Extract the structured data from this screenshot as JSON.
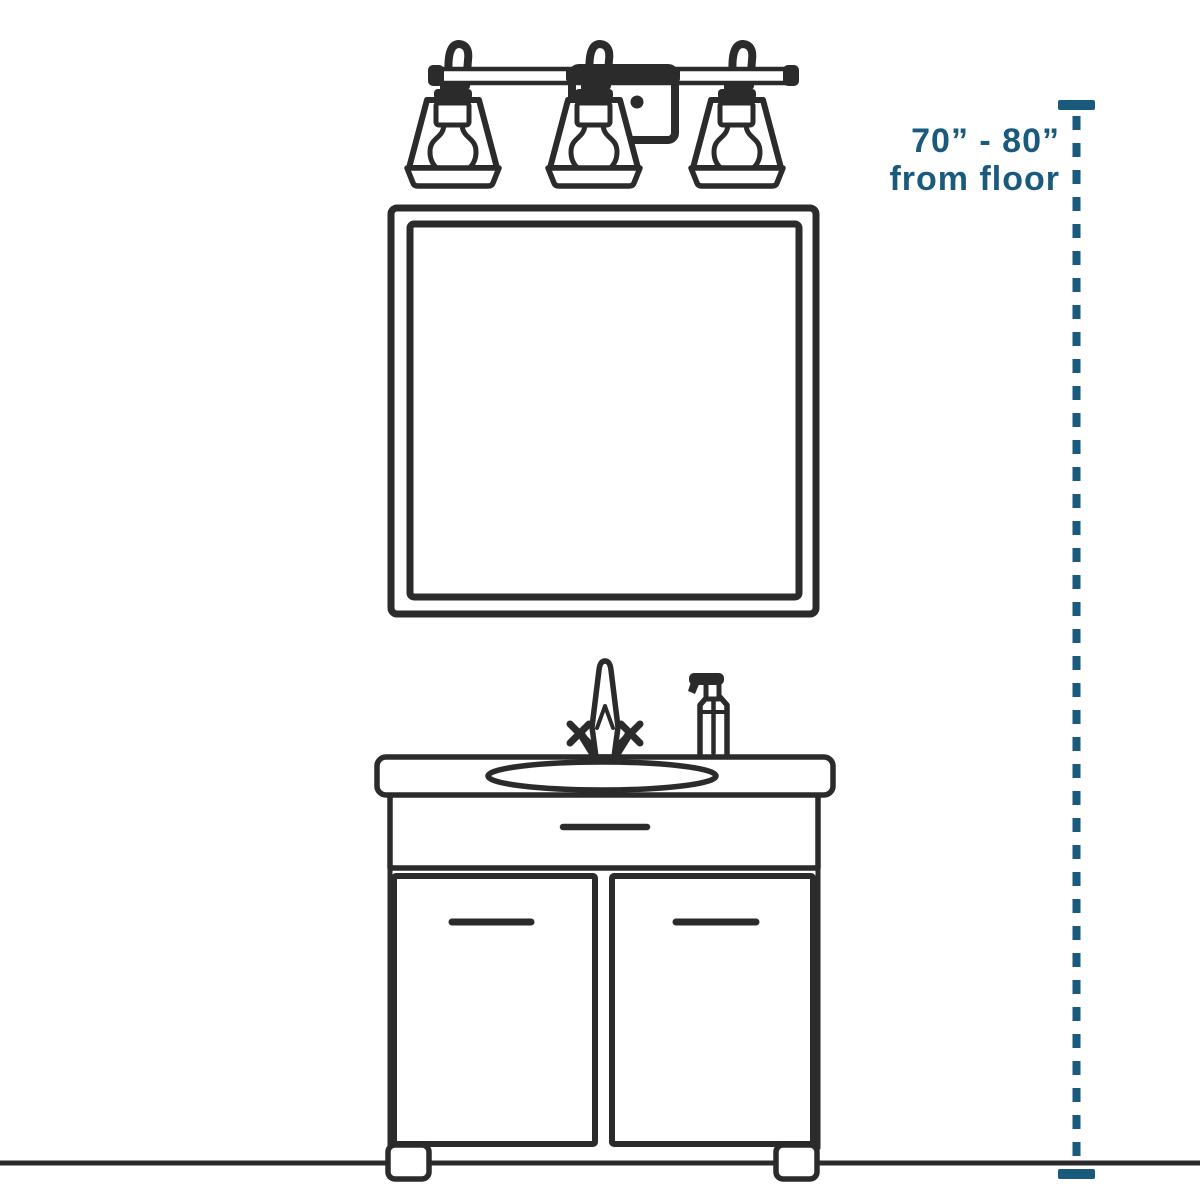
{
  "colors": {
    "ink": "#2b2b2b",
    "accent": "#1a5a7d",
    "background": "#ffffff"
  },
  "annotation": {
    "line1": "70” - 80”",
    "line2": "from floor"
  },
  "objects": {
    "light_fixture": "three-light-vanity-fixture-icon",
    "mirror": "square-mirror-icon",
    "vanity": "bathroom-vanity-cabinet-icon",
    "faucet": "faucet-icon",
    "soap": "soap-pump-icon",
    "measurement": "height-measurement-line"
  }
}
